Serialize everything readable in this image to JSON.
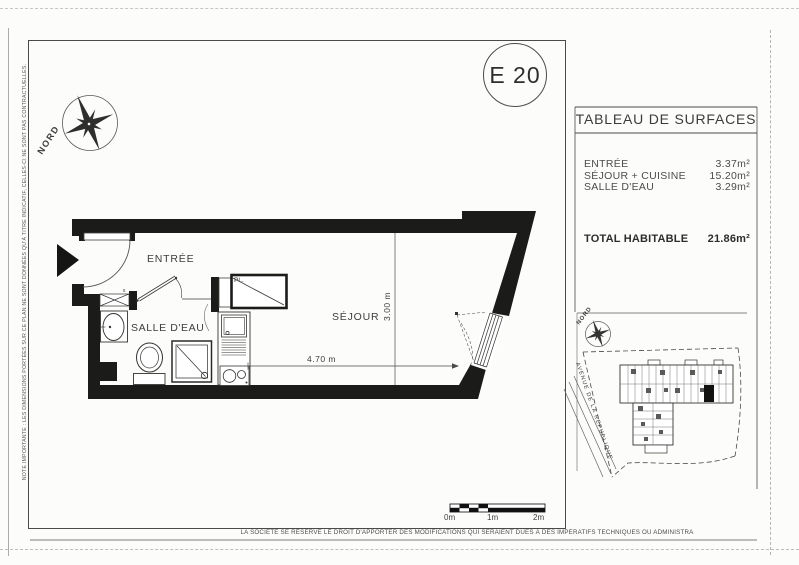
{
  "page": {
    "unit_label": "E 20",
    "note_left_vertical": "NOTE IMPORTANTE : LES DIMENSIONS PORTÉES SUR CE PLAN NE SONT DONNÉES QU'À TITRE INDICATIF, CELLES-CI NE SONT PAS CONTRACTUELLES.",
    "disclaimer_bottom": "LA SOCIÉTÉ SE RÉSERVE LE DROIT D'APPORTER DES MODIFICATIONS QUI SERAIENT DUES À DES IMPÉRATIFS TECHNIQUES OU ADMINISTRA"
  },
  "floor_plan": {
    "compass_label": "NORD",
    "rooms": [
      {
        "name": "ENTRÉE"
      },
      {
        "name": "SALLE D'EAU"
      },
      {
        "name": "SÉJOUR"
      }
    ],
    "closet_label": "PL.",
    "duct_marking": "tt",
    "dimensions": [
      {
        "label": "4.70 m"
      },
      {
        "label": "3.00 m"
      }
    ]
  },
  "surface_table": {
    "title": "TABLEAU DE SURFACES",
    "rows": [
      {
        "label": "ENTRÉE",
        "value": "3.37m²"
      },
      {
        "label": "SÉJOUR + CUISINE",
        "value": "15.20m²"
      },
      {
        "label": "SALLE D'EAU",
        "value": "3.29m²"
      }
    ],
    "total": {
      "label": "TOTAL HABITABLE",
      "value": "21.86m²"
    }
  },
  "site_map": {
    "compass_label": "NORD",
    "street_label": "AVENUE DE LA REPUBLIQUE"
  },
  "scale_bar": {
    "labels": [
      "0m",
      "1m",
      "2m"
    ]
  }
}
